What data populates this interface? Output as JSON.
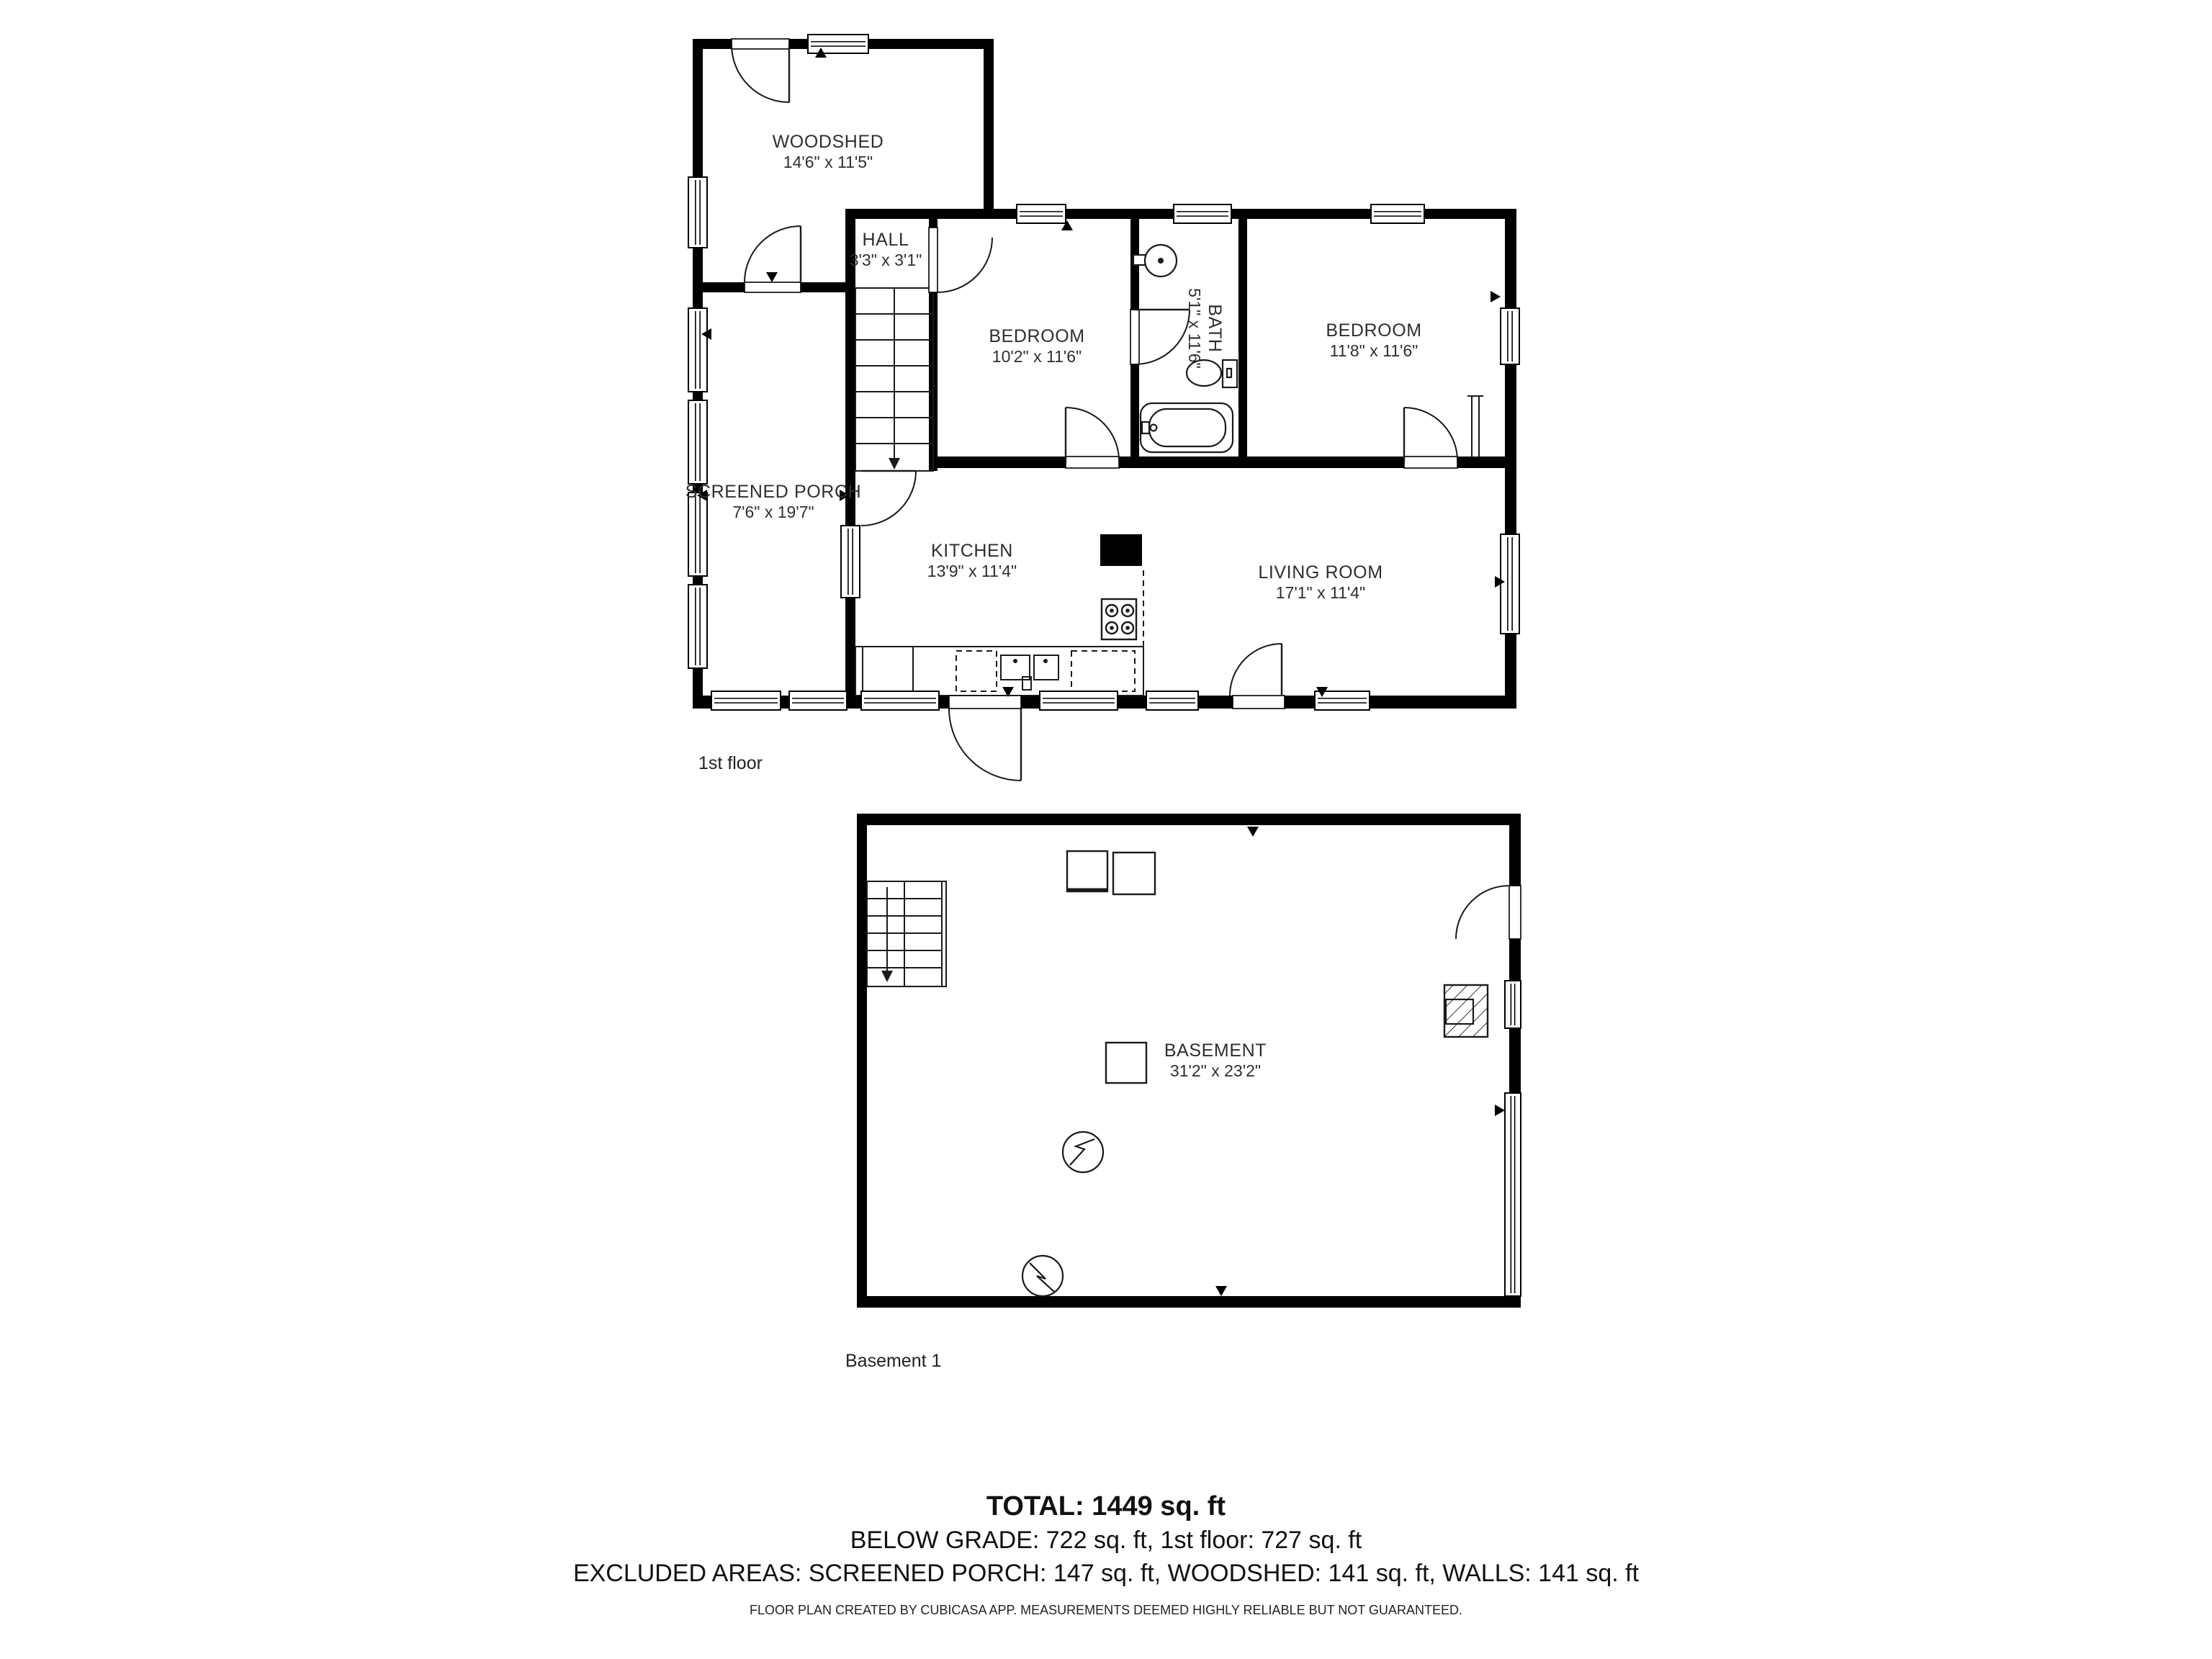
{
  "page": {
    "background": "#ffffff"
  },
  "colors": {
    "wall": "#000000",
    "label_text": "#2f2f2f"
  },
  "floors": [
    {
      "id": "first-floor",
      "caption": "1st floor",
      "rooms": [
        {
          "name": "WOODSHED",
          "dims": "14'6\" x 11'5\""
        },
        {
          "name": "HALL",
          "dims": "3'3\" x 3'1\""
        },
        {
          "name": "BEDROOM",
          "dims": "10'2\" x 11'6\""
        },
        {
          "name": "BATH",
          "dims": "5'1\" x 11'6\"",
          "rotated": true
        },
        {
          "name": "BEDROOM",
          "dims": "11'8\" x 11'6\""
        },
        {
          "name": "SCREENED PORCH",
          "dims": "7'6\" x 19'7\""
        },
        {
          "name": "KITCHEN",
          "dims": "13'9\" x 11'4\""
        },
        {
          "name": "LIVING ROOM",
          "dims": "17'1\" x 11'4\""
        }
      ]
    },
    {
      "id": "basement",
      "caption": "Basement 1",
      "rooms": [
        {
          "name": "BASEMENT",
          "dims": "31'2\" x 23'2\""
        }
      ]
    }
  ],
  "summary": {
    "total": "TOTAL: 1449 sq. ft",
    "grade_line": "BELOW GRADE: 722 sq. ft, 1st floor: 727 sq. ft",
    "excluded_line": "EXCLUDED AREAS: SCREENED PORCH: 147 sq. ft, WOODSHED: 141 sq. ft, WALLS: 141 sq. ft"
  },
  "disclaimer": "FLOOR PLAN CREATED BY CUBICASA APP. MEASUREMENTS DEEMED HIGHLY RELIABLE BUT NOT GUARANTEED."
}
